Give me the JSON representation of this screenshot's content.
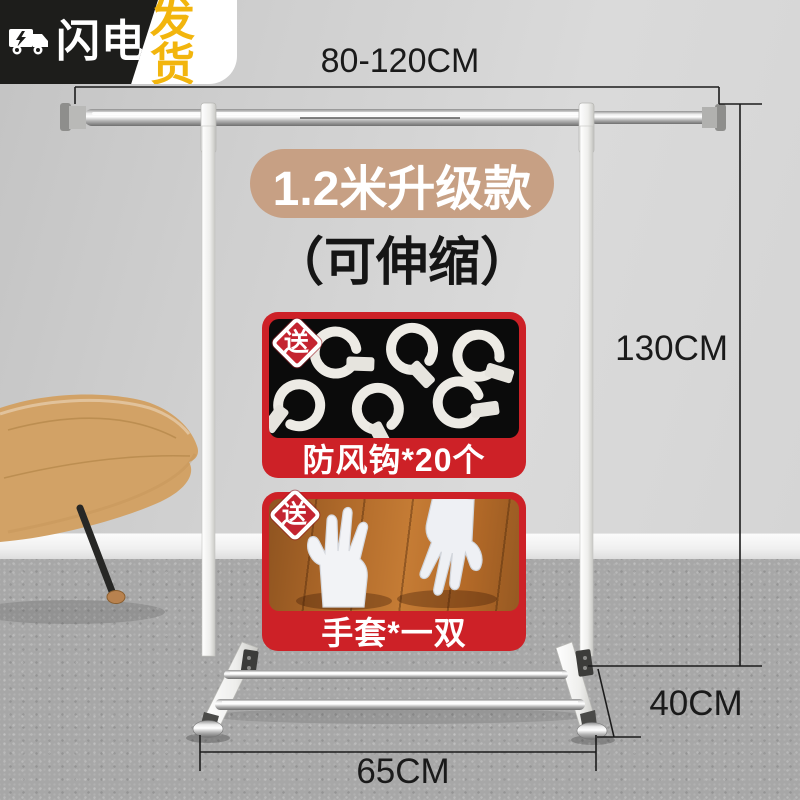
{
  "shipping_badge": {
    "left_text": "闪电",
    "right_text": "发货",
    "icon": "lightning-truck-icon"
  },
  "product": {
    "model_label": "1.2米升级款",
    "feature_label": "（可伸缩）"
  },
  "dimensions": {
    "top_rail": "80-120CM",
    "height": "130CM",
    "depth": "40CM",
    "base_width": "65CM"
  },
  "gifts": [
    {
      "tag": "送",
      "caption": "防风钩*20个",
      "photo": "white-windproof-hooks-on-black"
    },
    {
      "tag": "送",
      "caption": "手套*一双",
      "photo": "white-gloves-pair-on-wood"
    }
  ],
  "colors": {
    "promo_red": "#cd2127",
    "gift_badge_red": "#c42430",
    "model_pill_tan": "#c7a084",
    "brand_gold": "#f2b50d",
    "brand_black": "#1d1d1b"
  }
}
